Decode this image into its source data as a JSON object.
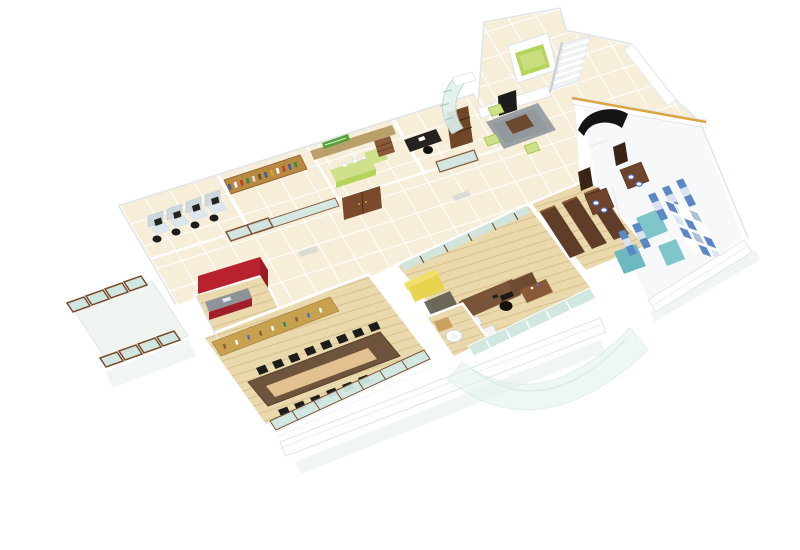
{
  "scene": {
    "description": "3D isometric cutaway render of an office floor plan on a white background",
    "view": "isometric-birds-eye",
    "background": "#ffffff"
  },
  "rooms": [
    {
      "id": "open-workstations",
      "floor": "cream-tile",
      "workstations": 4
    },
    {
      "id": "library-storage",
      "floor": "cream-tile",
      "bookshelf_wall": true
    },
    {
      "id": "reception-office",
      "floor": "cream-tile",
      "sign": "green",
      "counter": "lime",
      "double_door": "brown"
    },
    {
      "id": "private-cabin",
      "floor": "cream-tile",
      "desk": "black",
      "cabinet": "brown"
    },
    {
      "id": "entrance-lobby",
      "floor": "cream-tile",
      "lift": true,
      "staircase": true,
      "waiting_poufs": 3,
      "sofa": "black-curved",
      "coffee_table": "wood"
    },
    {
      "id": "pantry",
      "walls": "red",
      "water_bottle": "green"
    },
    {
      "id": "conference-room",
      "floor": "wood",
      "table": "long-brown",
      "chairs": 14,
      "credenza": "golden-wood"
    },
    {
      "id": "washroom-small",
      "basin": "white"
    },
    {
      "id": "executive-office",
      "floor": "wood",
      "sofa": "yellow",
      "guest_chairs": 2,
      "desk": "curved-brown"
    },
    {
      "id": "wardrobe-storage",
      "wardrobes": 3
    },
    {
      "id": "restrooms",
      "vanities": 2,
      "sinks": 4,
      "partitions": "blue-striped",
      "floor": "teal"
    },
    {
      "id": "storage-shelving",
      "grid": "blue-white"
    },
    {
      "id": "glass-balcony",
      "panels": 8,
      "frames": "brown"
    }
  ],
  "colors": {
    "background": "#ffffff",
    "tile_floor": "#f7eed9",
    "tile_grout": "#ffffff",
    "wood_floor": "#ead9ad",
    "wood_grain": "#d9c28e",
    "wing_floor": "#f6f8f9",
    "balcony_floor": "#f0f4f0",
    "wall_white": "#ffffff",
    "wall_edge": "#dfe5e9",
    "wall_shadow": "#eef1f3",
    "frame_brown": "#7b4a2c",
    "door_brown": "#6f4628",
    "door_dark": "#3a2416",
    "glass": "#cfe6e1",
    "glass_pale": "#e2f1ee",
    "lime": "#b5d45a",
    "lime_light": "#cfe08a",
    "green_sign": "#57a13c",
    "bottle_green": "#8fc83c",
    "red_wall": "#b8212e",
    "red_dark": "#9a1b26",
    "counter_gray": "#8d9499",
    "yellow_sofa": "#e8d44d",
    "yellow_sofa_light": "#f0e06a",
    "black": "#1c1c1c",
    "rug_gray": "#9aa0a4",
    "rug_dark": "#55544a",
    "table_brown": "#6e543c",
    "table_inlay": "#e3c08f",
    "credenza_gold": "#c8a14f",
    "bookshelf_gold": "#b8893f",
    "wood_wall": "#b9a06a",
    "wardrobe_brown": "#5f3d28",
    "vanity_brown": "#6e452a",
    "partition_blue": "#5b87c5",
    "partition_blue_light": "#aebfd8",
    "teal_floor": "#7ec6c9",
    "teal_deep": "#6db9bf",
    "sink_blue": "#4a6fd1",
    "gold_trim": "#d9a43c",
    "workstation_panel": "#cdd7de",
    "workstation_desk": "#dce6ec",
    "stair_base": "#eef2f5",
    "canopy": "#e4f2ef"
  }
}
